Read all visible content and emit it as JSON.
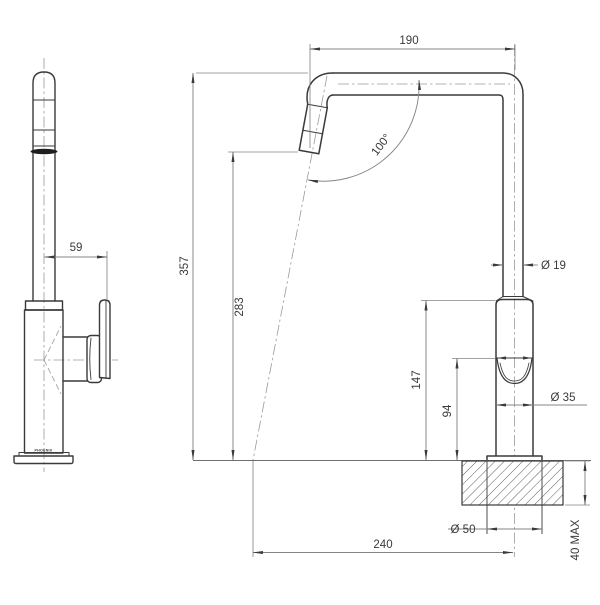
{
  "drawing": {
    "description_label": "tap technical dimension drawing",
    "views": {
      "left": "side-view",
      "right": "front-view"
    },
    "colors": {
      "background": "#ffffff",
      "outline": "#3a3a3a",
      "dimension_line": "#858585",
      "centerline": "#9a9a9a",
      "text": "#3a3a3a",
      "aerator_band": "#1e1e1e"
    }
  },
  "dimensions": {
    "spout_reach_top": {
      "label": "190"
    },
    "spout_angle": {
      "label": "100°"
    },
    "spout_tube_diameter": {
      "label": "Ø 19"
    },
    "overall_height": {
      "label": "357"
    },
    "outlet_height": {
      "label": "283"
    },
    "body_height": {
      "label": "147"
    },
    "handle_height": {
      "label": "94"
    },
    "body_diameter": {
      "label": "Ø 35"
    },
    "base_diameter": {
      "label": "Ø 50"
    },
    "reach_to_outlet": {
      "label": "240"
    },
    "bench_thickness": {
      "label": "40 MAX"
    },
    "handle_offset": {
      "label": "59"
    }
  },
  "branding": {
    "base_text": "PHOENIX"
  }
}
